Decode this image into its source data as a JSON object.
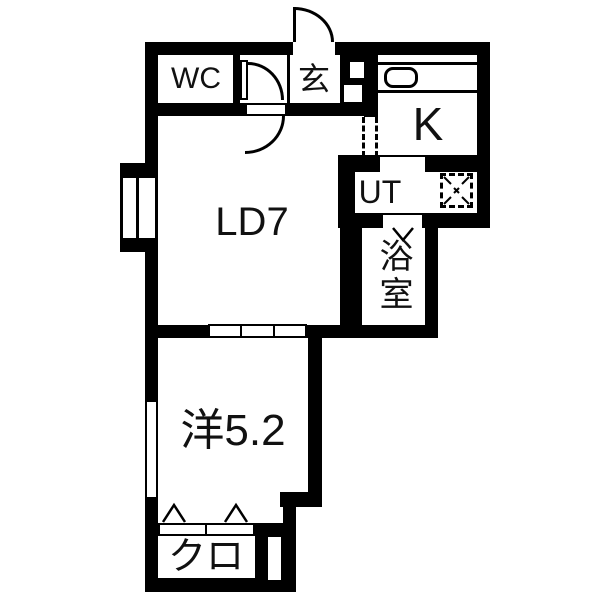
{
  "title": "1LDK apartment floor plan",
  "labels": {
    "wc": "WC",
    "entrance": "玄",
    "kitchen": "K",
    "utility": "UT",
    "bathroom": "浴室",
    "living_dining": "LD7",
    "western_room": "洋5.2",
    "closet": "クロ"
  },
  "colors": {
    "wall": "#000000",
    "background": "#ffffff",
    "text": "#111111"
  },
  "symbols": [
    "entrance-door-swing",
    "wc-door-swing",
    "living-door-swing",
    "bathroom-folding-door",
    "closet-bifold-door",
    "sliding-door-3-panel",
    "kitchen-sink",
    "washing-machine-space",
    "double-casement-window",
    "slot-window",
    "open-passage-dashed"
  ]
}
